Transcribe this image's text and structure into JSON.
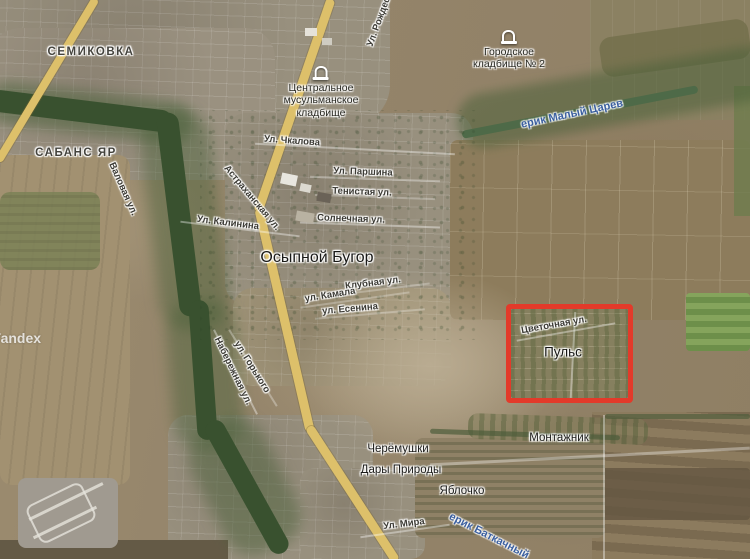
{
  "map": {
    "provider": "Yandex",
    "view_type": "satellite",
    "highlight_color": "#e33a2a",
    "water_label_color": "#3a5fa0"
  },
  "labels": {
    "semikovka": "СЕМИКОВКА",
    "sabans_yar": "САБАНС ЯР",
    "osypnoy_bugor": "Осыпной Бугор",
    "city_cemetery_line1": "Городское",
    "city_cemetery_line2": "кладбище № 2",
    "muslim_cemetery_line1": "Центральное",
    "muslim_cemetery_line2": "мусульманское",
    "muslim_cemetery_line3": "кладбище",
    "erik_maly_tsarev": "ерик Малый Царев",
    "erik_batkachny": "ерик Баткачный",
    "puls": "Пульс",
    "montazhnik": "Монтажник",
    "cheryomushki": "Черёмушки",
    "dary_prirody": "Дары Природы",
    "yablochko": "Яблочко",
    "st_chkalova": "Ул. Чкалова",
    "st_parshina": "Ул. Паршина",
    "st_tenistaya": "Тенистая ул.",
    "st_solnechnaya": "Солнечная ул.",
    "st_kalinina": "Ул. Калинина",
    "st_klubnaya": "Клубная ул.",
    "st_kamala": "ул. Камала",
    "st_esenina": "ул. Есенина",
    "st_tsvetochnaya": "Цветочная ул.",
    "st_astrakhanskaya": "Астраханская ул.",
    "st_valovaya": "Валовая ул.",
    "st_naberezhnaya": "Набережная ул.",
    "st_gorkogo": "ул. Горького",
    "st_mira": "Ул. Мира",
    "st_rozhdestvenskaya": "Ул. Рождественская",
    "watermark": "Yandex"
  }
}
